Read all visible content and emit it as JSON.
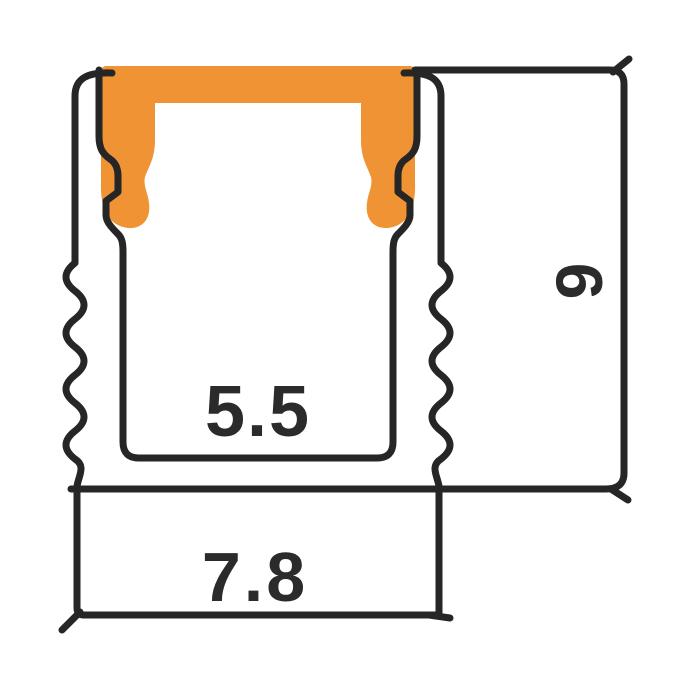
{
  "diagram": {
    "labels": {
      "inner_width": "5.5",
      "base_width": "7.8",
      "height": "9"
    }
  },
  "colors": {
    "line": "#262626",
    "text": "#2b2b2b",
    "cover_orange": "#EF9334",
    "background": "#FFFFFF"
  }
}
